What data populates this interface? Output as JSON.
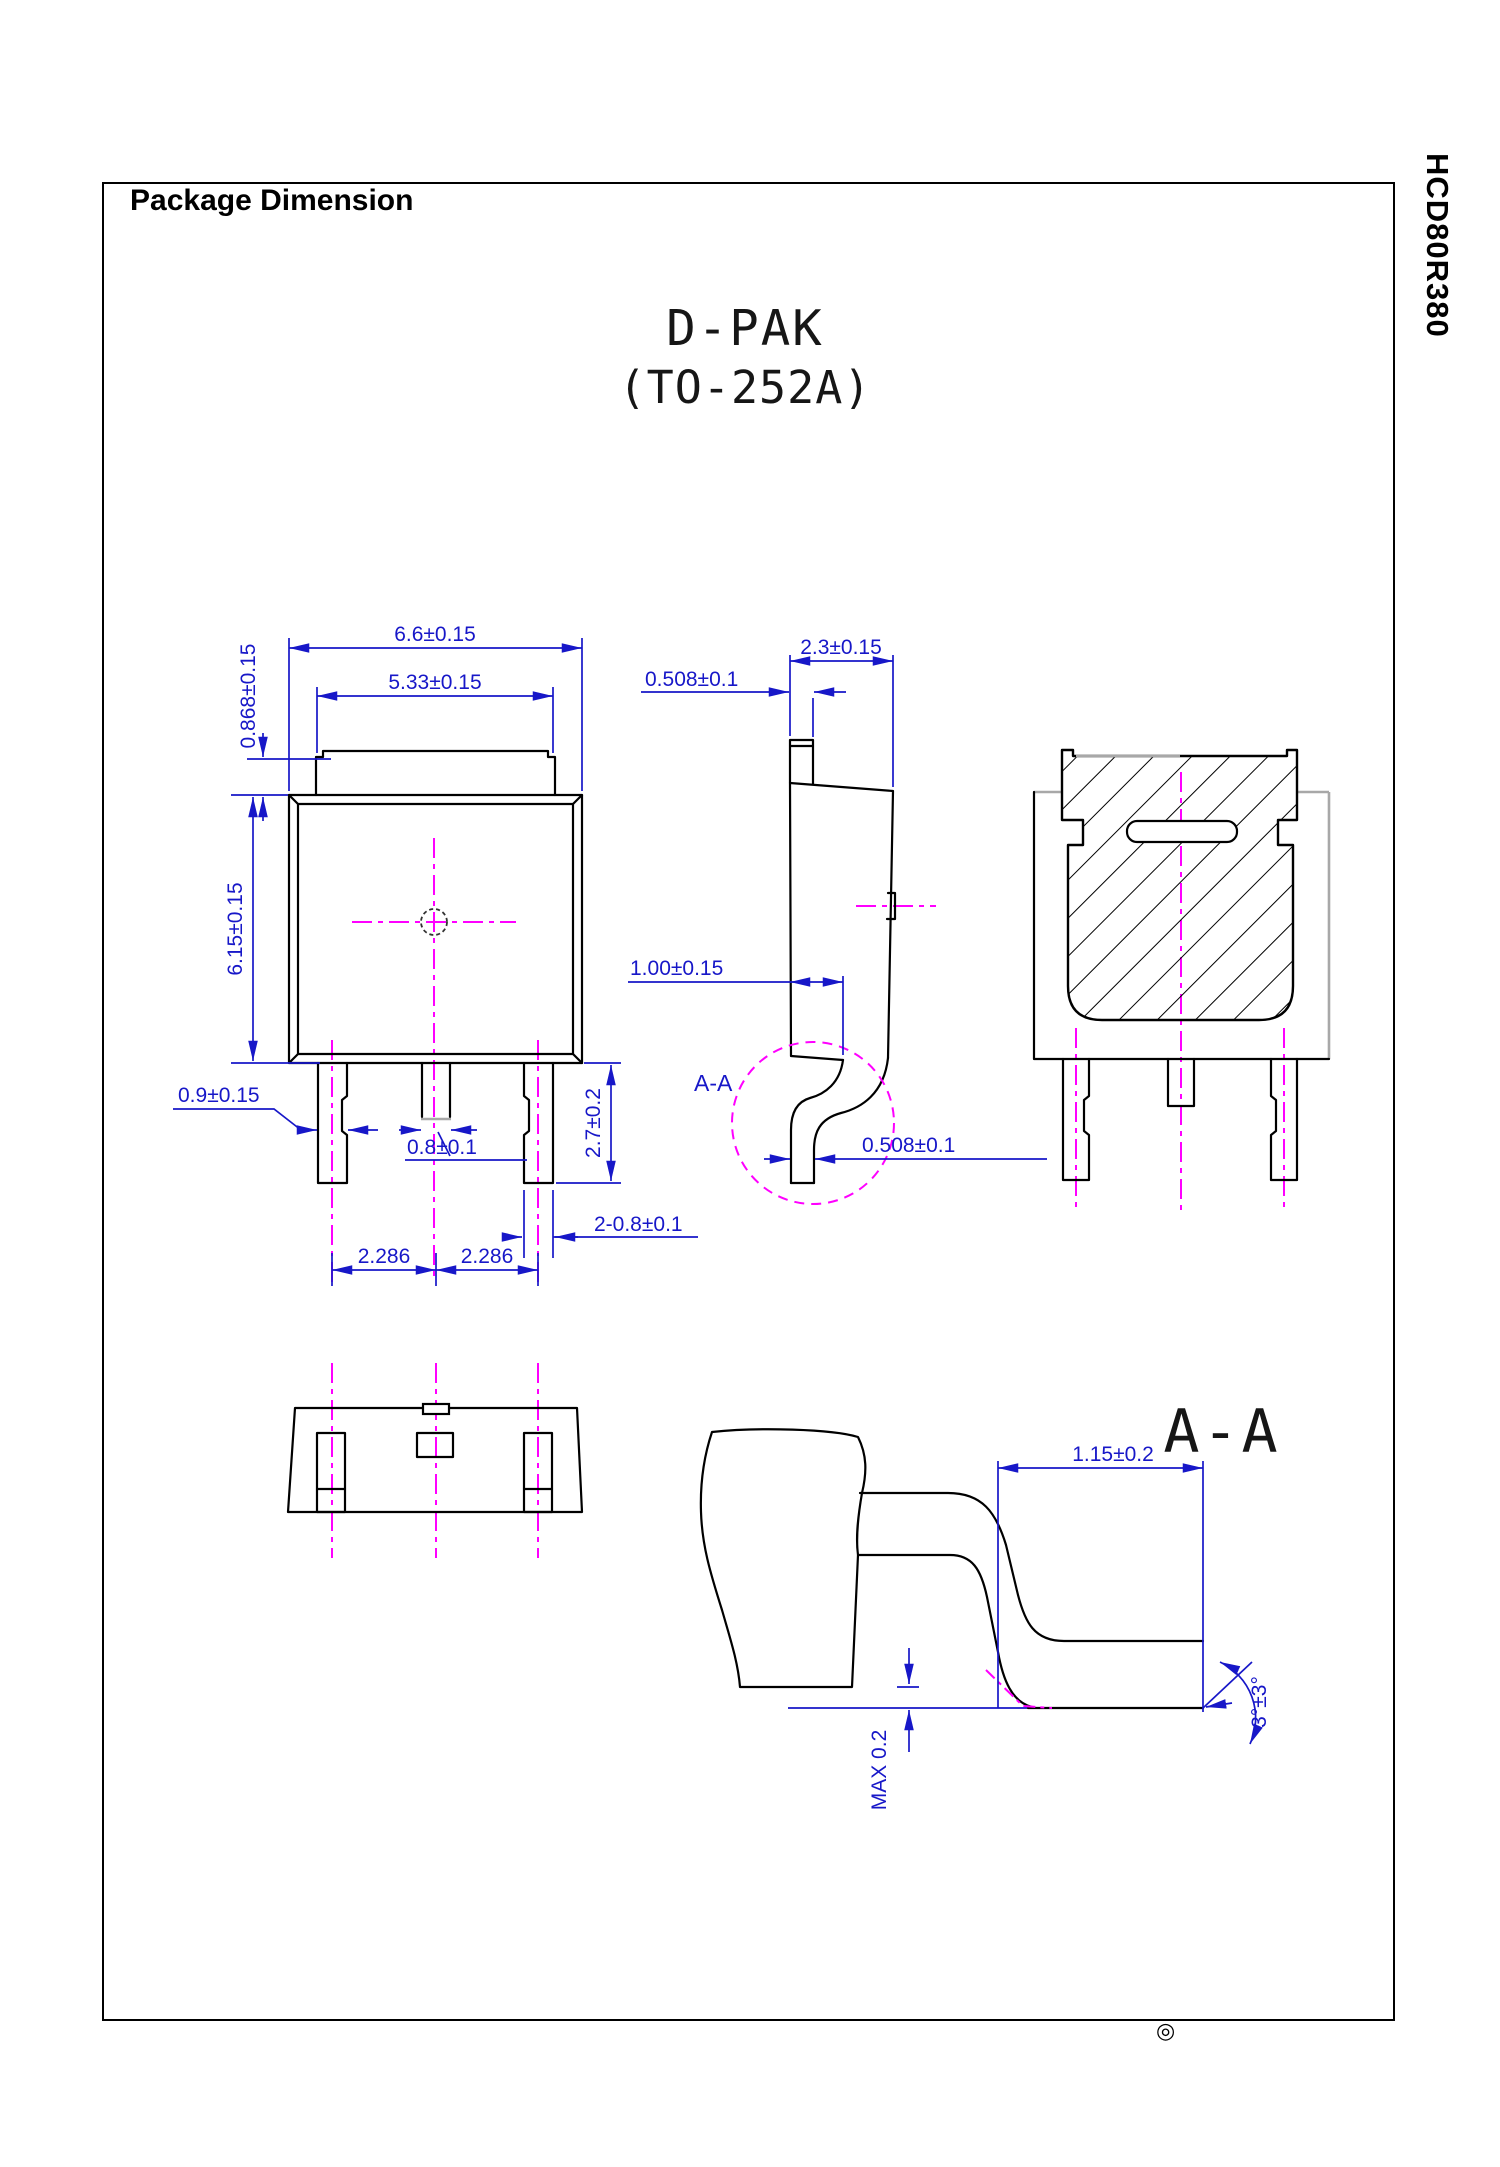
{
  "colors": {
    "dimension_blue": "#1717c8",
    "centerline_magenta": "#ff00ff",
    "outline_black": "#000000",
    "shade_gray": "#a8a8a8"
  },
  "header": {
    "title": "Package Dimension",
    "doc_code": "HCD80R380"
  },
  "drawing": {
    "package_name": "D-PAK",
    "package_code": "(TO-252A)",
    "registered_mark": "◎"
  },
  "front": {
    "dim_body_width": "6.6±0.15",
    "dim_tab_width": "5.33±0.15",
    "dim_tab_height": "0.868±0.15",
    "dim_body_height": "6.15±0.15",
    "dim_outer_lead_width": "0.9±0.15",
    "dim_center_lead_width": "0.8±0.1",
    "dim_lead_length": "2.7±0.2",
    "dim_outer_leads": "2-0.8±0.1",
    "dim_pitch_left": "2.286",
    "dim_pitch_right": "2.286"
  },
  "side": {
    "dim_thickness": "2.3±0.15",
    "dim_tab_thickness": "0.508±0.1",
    "dim_lead_offset": "1.00±0.15",
    "dim_lead_thickness": "0.508±0.1",
    "section_label": "A-A"
  },
  "detail": {
    "title": "A-A",
    "dim_foot_length": "1.15±0.2",
    "dim_standoff": "MAX 0.2",
    "dim_lead_angle": "3°±3°"
  }
}
